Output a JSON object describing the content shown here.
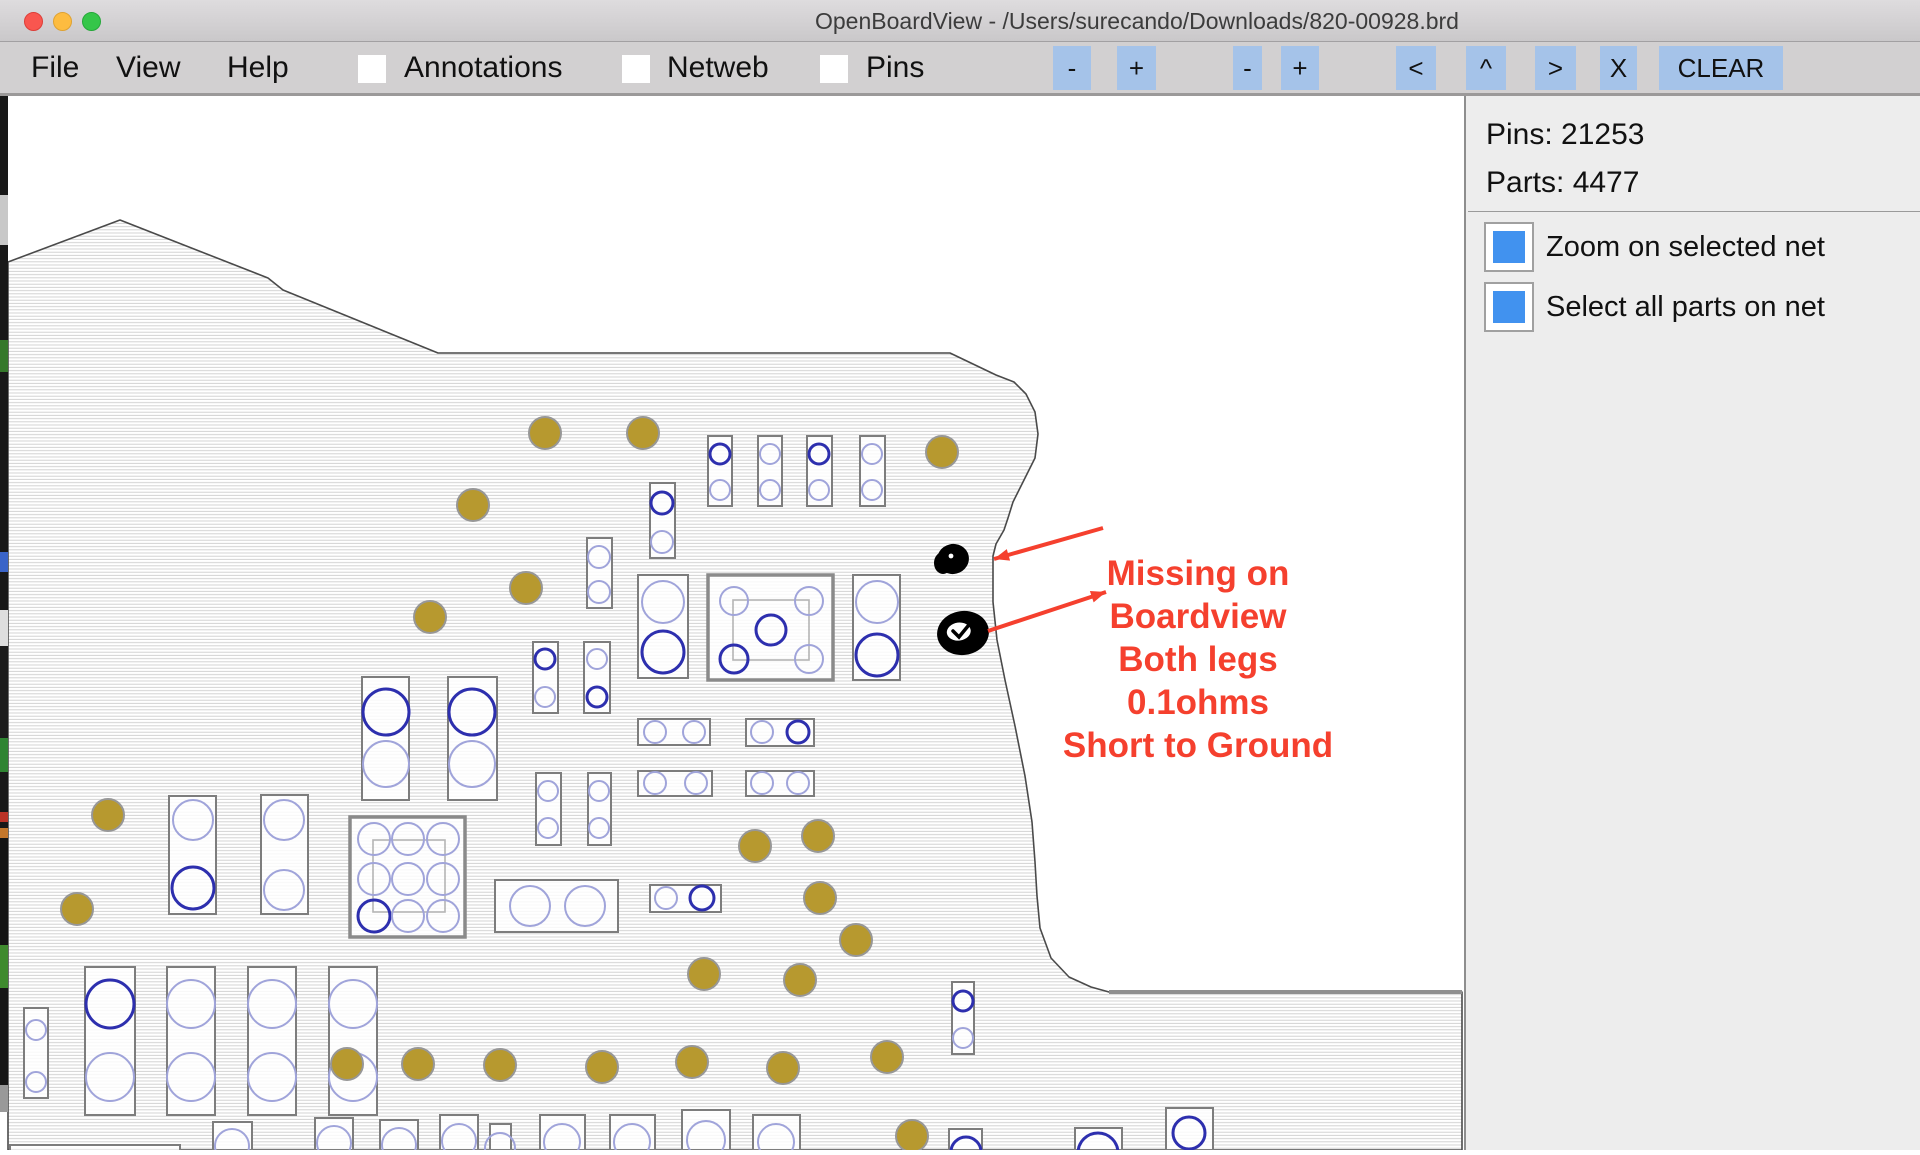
{
  "window": {
    "title": "OpenBoardView - /Users/surecando/Downloads/820-00928.brd",
    "traffic_lights": [
      "close",
      "minimize",
      "zoom"
    ]
  },
  "menu": {
    "items": [
      {
        "label": "File",
        "x": 31
      },
      {
        "label": "View",
        "x": 116
      },
      {
        "label": "Help",
        "x": 227
      }
    ],
    "toggles": [
      {
        "label": "Annotations",
        "cb_x": 358,
        "label_x": 404
      },
      {
        "label": "Netweb",
        "cb_x": 622,
        "label_x": 667
      },
      {
        "label": "Pins",
        "cb_x": 820,
        "label_x": 866
      }
    ],
    "toggle_color": "#4a90ee",
    "buttons": [
      {
        "label": "-",
        "x": 1053,
        "w": 38
      },
      {
        "label": "+",
        "x": 1117,
        "w": 39
      },
      {
        "label": "-",
        "x": 1233,
        "w": 29
      },
      {
        "label": "+",
        "x": 1281,
        "w": 38
      },
      {
        "label": "<",
        "x": 1396,
        "w": 40
      },
      {
        "label": "^",
        "x": 1466,
        "w": 40
      },
      {
        "label": ">",
        "x": 1535,
        "w": 41
      },
      {
        "label": "X",
        "x": 1600,
        "w": 37
      },
      {
        "label": "CLEAR",
        "x": 1659,
        "w": 124
      }
    ]
  },
  "sidebar": {
    "pins_label": "Pins: 21253",
    "parts_label": "Parts: 4477",
    "pins_count": 21253,
    "parts_count": 4477,
    "checkbox_color": "#4192ef",
    "options": [
      {
        "label": "Zoom on selected net",
        "checked": true
      },
      {
        "label": "Select all parts on net",
        "checked": true
      }
    ]
  },
  "annotation": {
    "lines": [
      "Missing on",
      "Boardview",
      "Both legs",
      "0.1ohms",
      "Short to Ground"
    ],
    "color": "#f5402e"
  },
  "board": {
    "colors": {
      "gold": "#b7992f",
      "gold_stroke": "#979797",
      "pin_dark": "#2d2fae",
      "pin_light": "#a0a4da",
      "comp_stroke": "#7d7d7d",
      "comp_inner": "#b5b5b5",
      "outline": "#4a4a4a",
      "hatch": "#cfcfcf",
      "notch": "#8f8f8f",
      "arrow": "#f5402e",
      "blob": "#000000"
    },
    "outline": [
      [
        8,
        262
      ],
      [
        120,
        220
      ],
      [
        268,
        278
      ],
      [
        283,
        290
      ],
      [
        438,
        353
      ],
      [
        950,
        353
      ],
      [
        996,
        375
      ],
      [
        1014,
        382
      ],
      [
        1026,
        394
      ],
      [
        1035,
        412
      ],
      [
        1038,
        434
      ],
      [
        1035,
        458
      ],
      [
        1026,
        476
      ],
      [
        1017,
        494
      ],
      [
        1013,
        502
      ],
      [
        1008,
        518
      ],
      [
        1004,
        530
      ],
      [
        996,
        544
      ],
      [
        993,
        556
      ],
      [
        993,
        602
      ],
      [
        997,
        640
      ],
      [
        1005,
        680
      ],
      [
        1015,
        726
      ],
      [
        1025,
        776
      ],
      [
        1032,
        822
      ],
      [
        1035,
        862
      ],
      [
        1037,
        896
      ],
      [
        1040,
        928
      ],
      [
        1051,
        958
      ],
      [
        1069,
        977
      ],
      [
        1091,
        987
      ],
      [
        1109,
        992
      ],
      [
        1462,
        992
      ],
      [
        1462,
        1150
      ],
      [
        8,
        1150
      ]
    ],
    "notch_line": [
      1109,
      992,
      1462,
      992
    ],
    "gold_pads": [
      [
        545,
        433
      ],
      [
        643,
        433
      ],
      [
        942,
        452
      ],
      [
        473,
        505
      ],
      [
        526,
        588
      ],
      [
        430,
        617
      ],
      [
        108,
        815
      ],
      [
        77,
        909
      ],
      [
        755,
        846
      ],
      [
        818,
        836
      ],
      [
        820,
        898
      ],
      [
        704,
        974
      ],
      [
        800,
        980
      ],
      [
        856,
        940
      ],
      [
        347,
        1064
      ],
      [
        418,
        1064
      ],
      [
        500,
        1065
      ],
      [
        602,
        1067
      ],
      [
        692,
        1062
      ],
      [
        783,
        1068
      ],
      [
        887,
        1057
      ],
      [
        912,
        1136
      ]
    ],
    "components": [
      {
        "x": 708,
        "y": 436,
        "w": 24,
        "h": 70,
        "k": "n",
        "c": [
          [
            720,
            454,
            10,
            "d"
          ],
          [
            720,
            490,
            10,
            "l"
          ]
        ]
      },
      {
        "x": 758,
        "y": 436,
        "w": 24,
        "h": 70,
        "k": "n",
        "c": [
          [
            770,
            454,
            10,
            "l"
          ],
          [
            770,
            490,
            10,
            "l"
          ]
        ]
      },
      {
        "x": 807,
        "y": 436,
        "w": 25,
        "h": 70,
        "k": "n",
        "c": [
          [
            819,
            454,
            10,
            "d"
          ],
          [
            819,
            490,
            10,
            "l"
          ]
        ]
      },
      {
        "x": 860,
        "y": 436,
        "w": 25,
        "h": 70,
        "k": "n",
        "c": [
          [
            872,
            454,
            10,
            "l"
          ],
          [
            872,
            490,
            10,
            "l"
          ]
        ]
      },
      {
        "x": 650,
        "y": 483,
        "w": 25,
        "h": 75,
        "k": "n",
        "c": [
          [
            662,
            503,
            11,
            "d"
          ],
          [
            662,
            542,
            11,
            "l"
          ]
        ]
      },
      {
        "x": 587,
        "y": 538,
        "w": 25,
        "h": 70,
        "k": "n",
        "c": [
          [
            599,
            557,
            11,
            "l"
          ],
          [
            599,
            592,
            11,
            "l"
          ]
        ]
      },
      {
        "x": 533,
        "y": 642,
        "w": 25,
        "h": 71,
        "k": "n",
        "c": [
          [
            545,
            659,
            10,
            "d"
          ],
          [
            545,
            697,
            10,
            "l"
          ]
        ]
      },
      {
        "x": 584,
        "y": 642,
        "w": 26,
        "h": 71,
        "k": "n",
        "c": [
          [
            597,
            659,
            10,
            "l"
          ],
          [
            597,
            697,
            10,
            "d"
          ]
        ]
      },
      {
        "x": 536,
        "y": 773,
        "w": 25,
        "h": 72,
        "k": "n",
        "c": [
          [
            548,
            791,
            10,
            "l"
          ],
          [
            548,
            828,
            10,
            "l"
          ]
        ]
      },
      {
        "x": 588,
        "y": 773,
        "w": 23,
        "h": 72,
        "k": "n",
        "c": [
          [
            599,
            791,
            10,
            "l"
          ],
          [
            599,
            828,
            10,
            "l"
          ]
        ]
      },
      {
        "x": 638,
        "y": 575,
        "w": 50,
        "h": 103,
        "k": "n",
        "c": [
          [
            663,
            602,
            21,
            "l"
          ],
          [
            663,
            652,
            21,
            "d"
          ]
        ]
      },
      {
        "x": 708,
        "y": 575,
        "w": 125,
        "h": 105,
        "k": "t",
        "i": [
          733,
          600,
          76,
          60
        ],
        "c": [
          [
            734,
            601,
            14,
            "l"
          ],
          [
            809,
            601,
            14,
            "l"
          ],
          [
            734,
            659,
            14,
            "d"
          ],
          [
            809,
            659,
            14,
            "l"
          ],
          [
            771,
            630,
            15,
            "d"
          ]
        ]
      },
      {
        "x": 853,
        "y": 575,
        "w": 47,
        "h": 105,
        "k": "n",
        "c": [
          [
            877,
            602,
            21,
            "l"
          ],
          [
            877,
            655,
            21,
            "d"
          ]
        ]
      },
      {
        "x": 362,
        "y": 677,
        "w": 47,
        "h": 123,
        "k": "n",
        "c": [
          [
            386,
            712,
            23,
            "d"
          ],
          [
            386,
            764,
            23,
            "l"
          ]
        ]
      },
      {
        "x": 448,
        "y": 677,
        "w": 49,
        "h": 123,
        "k": "n",
        "c": [
          [
            472,
            712,
            23,
            "d"
          ],
          [
            472,
            764,
            23,
            "l"
          ]
        ]
      },
      {
        "x": 169,
        "y": 796,
        "w": 47,
        "h": 118,
        "k": "n",
        "c": [
          [
            193,
            820,
            20,
            "l"
          ],
          [
            193,
            888,
            21,
            "d"
          ]
        ]
      },
      {
        "x": 261,
        "y": 795,
        "w": 47,
        "h": 119,
        "k": "n",
        "c": [
          [
            284,
            820,
            20,
            "l"
          ],
          [
            284,
            890,
            20,
            "l"
          ]
        ]
      },
      {
        "x": 638,
        "y": 719,
        "w": 72,
        "h": 26,
        "k": "n",
        "c": [
          [
            655,
            732,
            11,
            "l"
          ],
          [
            694,
            732,
            11,
            "l"
          ]
        ]
      },
      {
        "x": 746,
        "y": 719,
        "w": 68,
        "h": 27,
        "k": "n",
        "c": [
          [
            762,
            732,
            11,
            "l"
          ],
          [
            798,
            732,
            11,
            "d"
          ]
        ]
      },
      {
        "x": 638,
        "y": 771,
        "w": 74,
        "h": 25,
        "k": "n",
        "c": [
          [
            655,
            783,
            11,
            "l"
          ],
          [
            696,
            783,
            11,
            "l"
          ]
        ]
      },
      {
        "x": 746,
        "y": 771,
        "w": 68,
        "h": 25,
        "k": "n",
        "c": [
          [
            762,
            783,
            11,
            "l"
          ],
          [
            798,
            783,
            11,
            "l"
          ]
        ]
      },
      {
        "x": 650,
        "y": 885,
        "w": 71,
        "h": 27,
        "k": "n",
        "c": [
          [
            666,
            898,
            11,
            "l"
          ],
          [
            702,
            898,
            12,
            "d"
          ]
        ]
      },
      {
        "x": 495,
        "y": 880,
        "w": 123,
        "h": 52,
        "k": "n",
        "c": [
          [
            530,
            906,
            20,
            "l"
          ],
          [
            585,
            906,
            20,
            "l"
          ]
        ]
      },
      {
        "x": 350,
        "y": 817,
        "w": 115,
        "h": 120,
        "k": "t",
        "i": [
          373,
          840,
          72,
          72
        ],
        "c": [
          [
            374,
            839,
            16,
            "l"
          ],
          [
            408,
            839,
            16,
            "l"
          ],
          [
            443,
            839,
            16,
            "l"
          ],
          [
            374,
            879,
            16,
            "l"
          ],
          [
            408,
            879,
            16,
            "l"
          ],
          [
            443,
            879,
            16,
            "l"
          ],
          [
            374,
            916,
            16,
            "d"
          ],
          [
            408,
            916,
            16,
            "l"
          ],
          [
            443,
            916,
            16,
            "l"
          ]
        ]
      },
      {
        "x": 24,
        "y": 1008,
        "w": 24,
        "h": 90,
        "k": "n",
        "c": [
          [
            36,
            1030,
            10,
            "l"
          ],
          [
            36,
            1082,
            10,
            "l"
          ]
        ]
      },
      {
        "x": 85,
        "y": 967,
        "w": 50,
        "h": 148,
        "k": "n",
        "c": [
          [
            110,
            1004,
            24,
            "d"
          ],
          [
            110,
            1077,
            24,
            "l"
          ]
        ]
      },
      {
        "x": 167,
        "y": 967,
        "w": 48,
        "h": 148,
        "k": "n",
        "c": [
          [
            191,
            1004,
            24,
            "l"
          ],
          [
            191,
            1077,
            24,
            "l"
          ]
        ]
      },
      {
        "x": 248,
        "y": 967,
        "w": 48,
        "h": 148,
        "k": "n",
        "c": [
          [
            272,
            1004,
            24,
            "l"
          ],
          [
            272,
            1077,
            24,
            "l"
          ]
        ]
      },
      {
        "x": 329,
        "y": 967,
        "w": 48,
        "h": 148,
        "k": "n",
        "c": [
          [
            353,
            1004,
            24,
            "l"
          ],
          [
            353,
            1077,
            24,
            "l"
          ]
        ]
      },
      {
        "x": 952,
        "y": 982,
        "w": 22,
        "h": 72,
        "k": "n",
        "c": [
          [
            963,
            1001,
            10,
            "d"
          ],
          [
            963,
            1038,
            10,
            "l"
          ]
        ]
      },
      {
        "x": 213,
        "y": 1122,
        "w": 39,
        "h": 28,
        "k": "n",
        "c": [
          [
            232,
            1146,
            17,
            "l"
          ]
        ]
      },
      {
        "x": 315,
        "y": 1118,
        "w": 38,
        "h": 32,
        "k": "n",
        "c": [
          [
            334,
            1143,
            17,
            "l"
          ]
        ]
      },
      {
        "x": 380,
        "y": 1120,
        "w": 38,
        "h": 30,
        "k": "n",
        "c": [
          [
            399,
            1145,
            17,
            "l"
          ]
        ]
      },
      {
        "x": 440,
        "y": 1115,
        "w": 38,
        "h": 35,
        "k": "n",
        "c": [
          [
            459,
            1141,
            17,
            "l"
          ]
        ]
      },
      {
        "x": 490,
        "y": 1124,
        "w": 21,
        "h": 26,
        "k": "n",
        "c": [
          [
            500,
            1148,
            15,
            "l"
          ]
        ]
      },
      {
        "x": 540,
        "y": 1115,
        "w": 45,
        "h": 35,
        "k": "n",
        "c": [
          [
            562,
            1142,
            18,
            "l"
          ]
        ]
      },
      {
        "x": 610,
        "y": 1115,
        "w": 45,
        "h": 35,
        "k": "n",
        "c": [
          [
            632,
            1142,
            18,
            "l"
          ]
        ]
      },
      {
        "x": 682,
        "y": 1110,
        "w": 48,
        "h": 40,
        "k": "n",
        "c": [
          [
            706,
            1140,
            19,
            "l"
          ]
        ]
      },
      {
        "x": 753,
        "y": 1115,
        "w": 47,
        "h": 35,
        "k": "n",
        "c": [
          [
            776,
            1142,
            18,
            "l"
          ]
        ]
      },
      {
        "x": 949,
        "y": 1129,
        "w": 33,
        "h": 21,
        "k": "n",
        "c": [
          [
            966,
            1152,
            15,
            "d"
          ]
        ]
      },
      {
        "x": 1075,
        "y": 1128,
        "w": 47,
        "h": 22,
        "k": "n",
        "c": [
          [
            1098,
            1153,
            20,
            "d"
          ]
        ]
      },
      {
        "x": 1166,
        "y": 1108,
        "w": 47,
        "h": 42,
        "k": "n",
        "c": [
          [
            1189,
            1133,
            16,
            "d"
          ]
        ]
      },
      {
        "x": 10,
        "y": 1145,
        "w": 170,
        "h": 10,
        "k": "n",
        "c": []
      }
    ],
    "blobs": {
      "solid": {
        "cx": 953,
        "cy": 559,
        "rx": 16,
        "ry": 15
      },
      "ring": {
        "cx": 963,
        "cy": 633,
        "rx": 26,
        "ry": 22,
        "irx": 12,
        "iry": 9
      }
    },
    "arrows": [
      {
        "x1": 1103,
        "y1": 528,
        "x2": 994,
        "y2": 559
      },
      {
        "x1": 988,
        "y1": 631,
        "x2": 1106,
        "y2": 592
      }
    ],
    "edge_sliver": [
      [
        96,
        195,
        "#181818"
      ],
      [
        195,
        245,
        "#c8c8c8"
      ],
      [
        245,
        340,
        "#181818"
      ],
      [
        340,
        372,
        "#35782b"
      ],
      [
        372,
        552,
        "#181818"
      ],
      [
        552,
        572,
        "#3a64c8"
      ],
      [
        572,
        610,
        "#181818"
      ],
      [
        610,
        646,
        "#dedede"
      ],
      [
        646,
        738,
        "#1c1c1c"
      ],
      [
        738,
        772,
        "#2f8432"
      ],
      [
        772,
        812,
        "#181818"
      ],
      [
        812,
        822,
        "#bb3327"
      ],
      [
        822,
        828,
        "#181818"
      ],
      [
        828,
        838,
        "#c4772b"
      ],
      [
        838,
        945,
        "#141414"
      ],
      [
        945,
        988,
        "#3f8a2e"
      ],
      [
        988,
        1085,
        "#161616"
      ],
      [
        1085,
        1112,
        "#999999"
      ]
    ]
  }
}
